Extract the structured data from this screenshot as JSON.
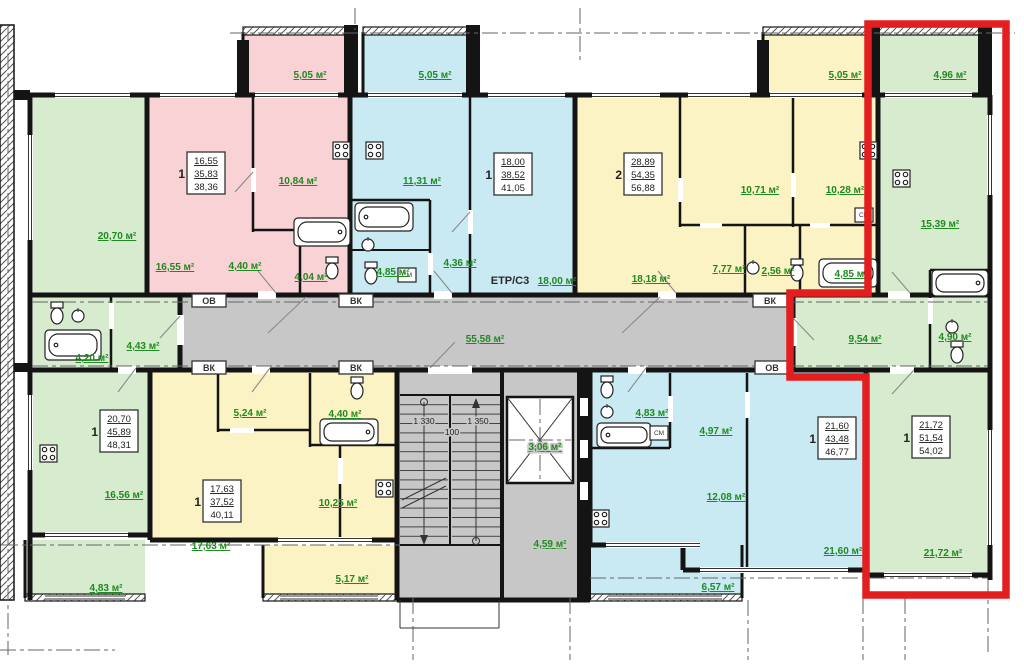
{
  "title": "apartment-building-floor-plan",
  "colors": {
    "pink": "#f8d2d4",
    "blue": "#c9eaf3",
    "yellow": "#fbf3c4",
    "green": "#d7ebcf",
    "corridor_gray": "#c7c7c7",
    "wall": "#141414",
    "area_text_green": "#1f8a1f",
    "highlight_red": "#e31e1e"
  },
  "corridor": {
    "area": "55,58 м²"
  },
  "stairwell": {
    "dim_left": "1 330",
    "dim_mid": "100",
    "dim_right": "1 350"
  },
  "elevator": {
    "area": "3,06 м²"
  },
  "vestibule": {
    "area": "4,59 м²"
  },
  "risers": {
    "ov": "ОВ",
    "vk": "ВК"
  },
  "misc": {
    "etr": "ЕТР/С3",
    "cm": "СМ"
  },
  "apartments": {
    "left_green": {
      "rooms_count": "1",
      "spec": [
        "20,70",
        "45,89",
        "48,31"
      ],
      "living": "20,70 м²",
      "hall": "4,43 м²",
      "bath": "4,20 м²",
      "kitchen": "16,56 м²",
      "balcony": "4,83 м²"
    },
    "pink": {
      "rooms_count": "1",
      "spec": [
        "16,55",
        "35,83",
        "38,36"
      ],
      "living": "16,55 м²",
      "kitchen": "10,84 м²",
      "hall": "4,40 м²",
      "wc": "4,04 м²",
      "balcony": "5,05 м²"
    },
    "top_blue": {
      "rooms_count": "1",
      "spec": [
        "18,00",
        "38,52",
        "41,05"
      ],
      "kitchen": "11,31 м²",
      "living": "18,00 м²",
      "hall": "4,36 м²",
      "bath": "4,85 м²",
      "balcony": "5,05 м²"
    },
    "top_yellow": {
      "rooms_count": "2",
      "spec": [
        "28,89",
        "54,35",
        "56,88"
      ],
      "living": "18,18 м²",
      "bedroom": "10,71 м²",
      "kitchen": "10,28 м²",
      "hall": "7,77 м²",
      "wc": "2,56 м²",
      "bath": "4,85 м²",
      "balcony": "5,05 м²"
    },
    "right_green": {
      "highlighted": true,
      "rooms_count": "1",
      "spec": [
        "21,72",
        "51,54",
        "54,02"
      ],
      "kitchen": "15,39 м²",
      "hall": "9,54 м²",
      "bath": "4,90 м²",
      "living": "21,72 м²",
      "balcony": "4,96 м²"
    },
    "bottom_yellow": {
      "rooms_count": "1",
      "spec": [
        "17,63",
        "37,52",
        "40,11"
      ],
      "hall": "5,24 м²",
      "bath": "4,40 м²",
      "living": "17,63 м²",
      "kitchen": "10,25 м²",
      "balcony": "5,17 м²"
    },
    "bottom_blue": {
      "rooms_count": "1",
      "spec": [
        "21,60",
        "43,48",
        "46,77"
      ],
      "bath": "4,83 м²",
      "hall": "4,97 м²",
      "kitchen": "12,08 м²",
      "living": "21,60 м²",
      "balcony": "6,57 м²"
    }
  }
}
